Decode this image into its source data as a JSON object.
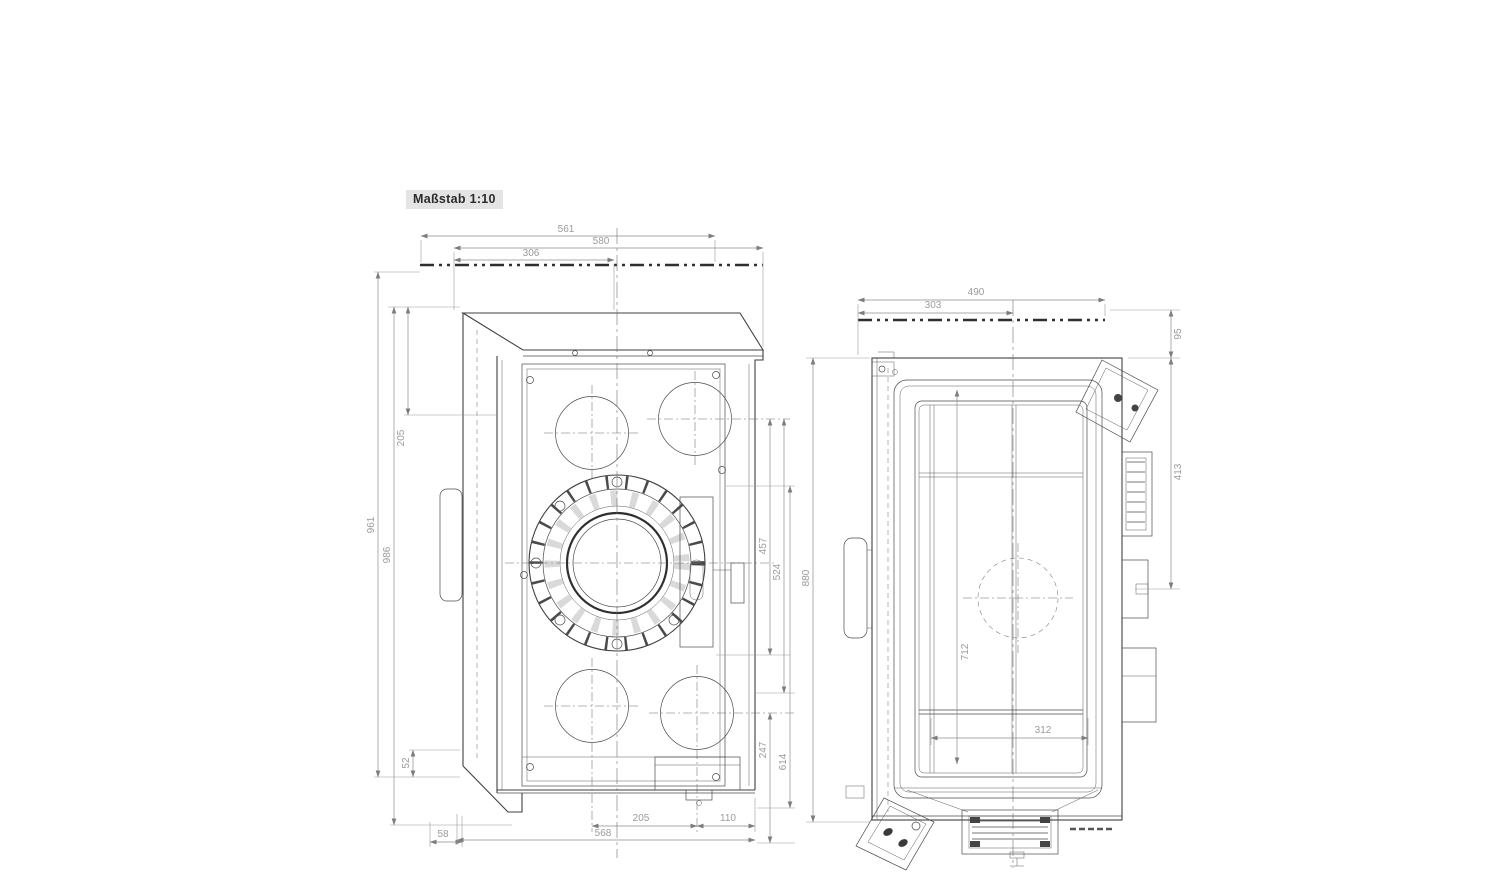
{
  "scale_label": "Maßstab 1:10",
  "colors": {
    "background": "#ffffff",
    "part_lines": "#3f3f3f",
    "dimension_lines": "#8d8d8d",
    "dimension_text": "#9b9b9b",
    "scale_box_bg": "#e4e4e4"
  },
  "front_view": {
    "dims": {
      "w561": "561",
      "w580": "580",
      "w306": "306",
      "h205": "205",
      "h961": "961",
      "h986": "986",
      "h52": "52",
      "w58": "58",
      "w205": "205",
      "w110": "110",
      "w568": "568",
      "h457": "457",
      "h524": "524",
      "h247": "247",
      "h614": "614"
    }
  },
  "side_view": {
    "dims": {
      "w490": "490",
      "w303": "303",
      "h95": "95",
      "h413": "413",
      "h880": "880",
      "h712": "712",
      "w312": "312"
    }
  }
}
